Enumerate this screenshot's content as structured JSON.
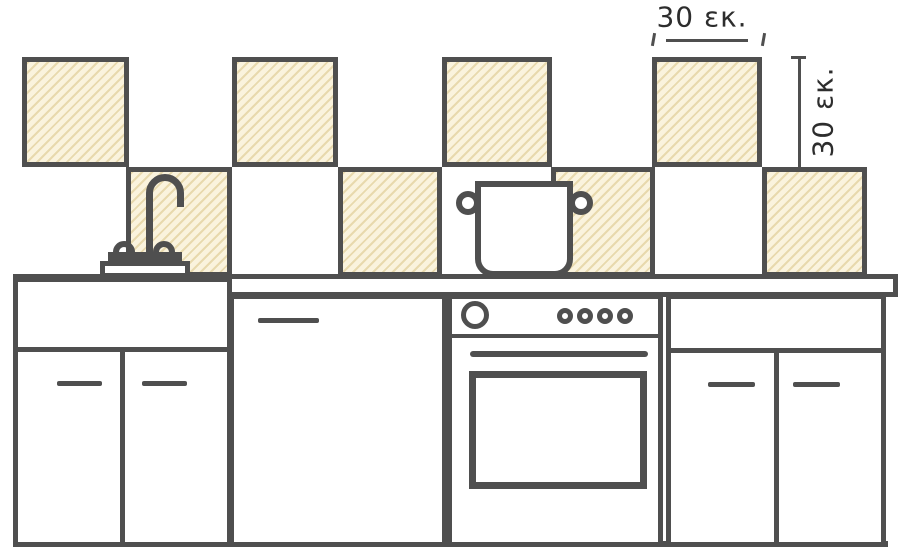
{
  "diagram": {
    "subject": "kitchen-backsplash-tile-spacing",
    "annotations": {
      "tile_width_label": "30 εκ.",
      "tile_height_label": "30 εκ."
    },
    "backsplash": {
      "pattern": "checkerboard",
      "rows": 2,
      "hatched_tiles_top_row": 4,
      "hatched_tiles_bottom_row": 4
    },
    "fixtures": [
      "faucet",
      "cooking-pot",
      "sink-cabinet",
      "dishwasher",
      "oven",
      "right-cabinet",
      "countertop"
    ],
    "colors": {
      "outline": "#4f4f4f",
      "tile_fill": "#faf3dd",
      "tile_hatch": "#e8d9ad",
      "background": "#ffffff",
      "text": "#2d2d2d"
    }
  }
}
